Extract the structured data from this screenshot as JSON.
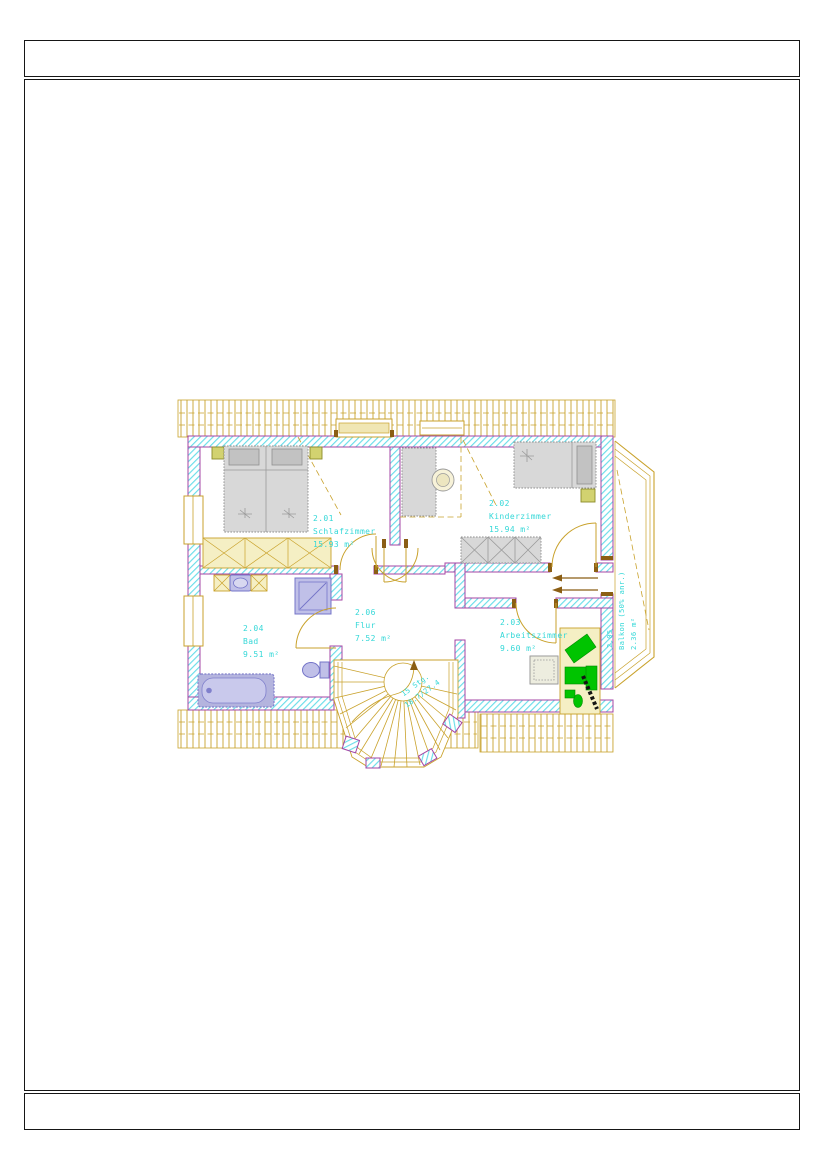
{
  "drawing": {
    "type": "floor-plan",
    "floor": "Dachgeschoss / upper floor",
    "rooms": [
      {
        "number": "2.01",
        "name": "Schlafzimmer",
        "area": "15.93 m²"
      },
      {
        "number": "2.02",
        "name": "Kinderzimmer",
        "area": "15.94 m²"
      },
      {
        "number": "2.03",
        "name": "Arbeitszimmer",
        "area": "9.60 m²"
      },
      {
        "number": "2.04",
        "name": "Bad",
        "area": "9.51 m²"
      },
      {
        "number": "2.06",
        "name": "Flur",
        "area": "7.52 m²"
      },
      {
        "number": "2.05",
        "name": "Balkon (50% anr.)",
        "area": "2.36 m²"
      }
    ],
    "stair": {
      "steps_label": "15 Stg.",
      "rise_run": "18.7/27.4"
    },
    "colors": {
      "label_cyan": "#35D8D8",
      "wall_purple": "#A546A5",
      "wall_hatch_cyan": "#62DCE8",
      "roof_gold": "#C9A22C",
      "fixture_blue": "#7474C8",
      "furniture_green": "#00C400"
    }
  }
}
